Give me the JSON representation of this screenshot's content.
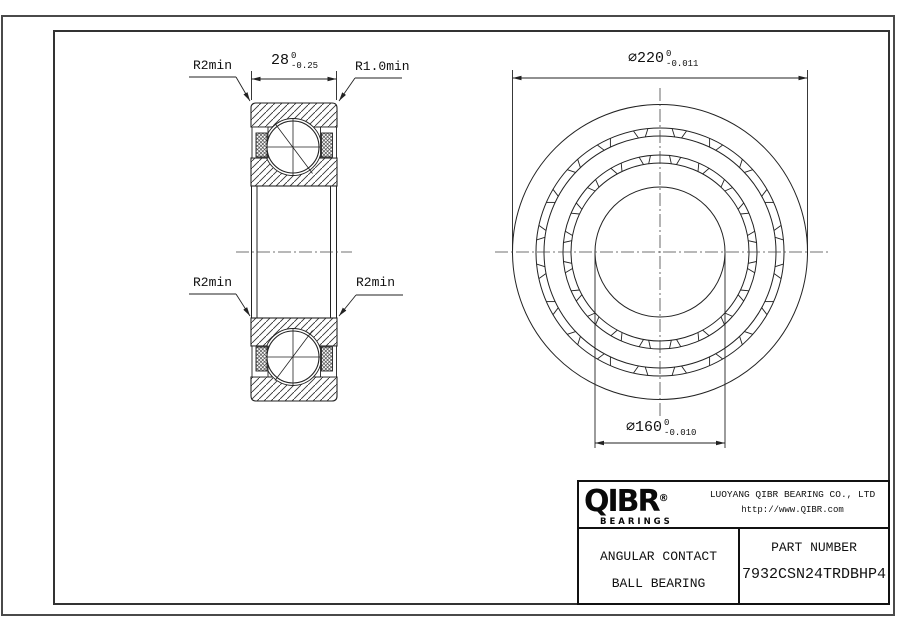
{
  "title_block": {
    "logo": {
      "text": "QIBR",
      "registered": "®",
      "subtext": "BEARINGS"
    },
    "company": "LUOYANG QIBR BEARING CO., LTD",
    "website": "http://www.QIBR.com",
    "product_line1": "ANGULAR CONTACT",
    "product_line2": "BALL BEARING",
    "part_number_label": "PART NUMBER",
    "part_number": "7932CSN24TRDBHP4"
  },
  "dimensions": {
    "width": {
      "value": "28",
      "tol_upper": "0",
      "tol_lower": "-0.25"
    },
    "outer_diameter": {
      "value": "⌀220",
      "tol_upper": "0",
      "tol_lower": "-0.011"
    },
    "bore_diameter": {
      "value": "⌀160",
      "tol_upper": "0",
      "tol_lower": "-0.010"
    },
    "radius_label_top_left": "R2min",
    "radius_label_top_right": "R1.0min",
    "radius_label_bottom_left": "R2min",
    "radius_label_bottom_right": "R2min"
  },
  "colors": {
    "line": "#222222",
    "text": "#111111"
  }
}
